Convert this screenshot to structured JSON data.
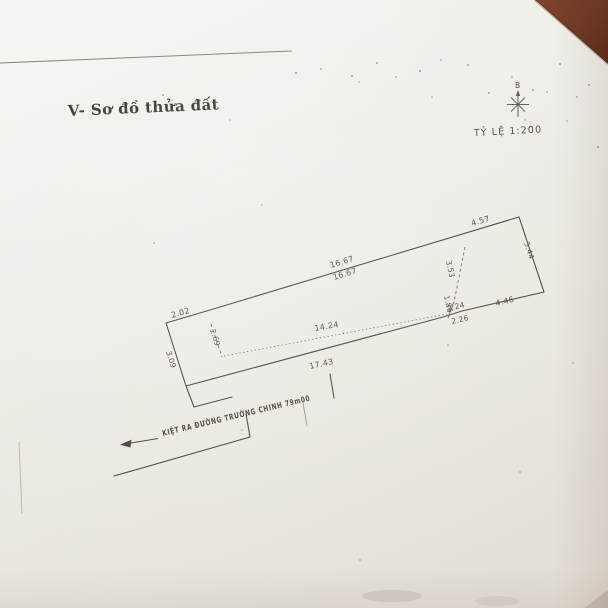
{
  "document": {
    "section_title": "V- Sơ đồ thửa đất",
    "scale_label": "TỶ LỆ 1:200",
    "compass": {
      "north_label": "B"
    },
    "alley_note": "KIỆT RA ĐƯỜNG TRƯỜNG CHINH 79m00"
  },
  "parcel_dimensions": {
    "top_left_segment": "2.02",
    "top_edge_outer": "16.67",
    "top_edge_inner": "16.67",
    "top_right_segment": "4.57",
    "right_edge": "5.44",
    "right_depth": "3.53",
    "right_step": "1.86",
    "bottom_right_segment": "4.46",
    "step_outer": "2.24",
    "step_inner": "2.26",
    "inner_width": "14.24",
    "left_depth": "2.69",
    "left_edge": "3.09",
    "bottom_edge": "17.43"
  },
  "colors": {
    "paper": "#efece7",
    "ink": "#45413b",
    "table_corner": "#6b2f1d"
  }
}
